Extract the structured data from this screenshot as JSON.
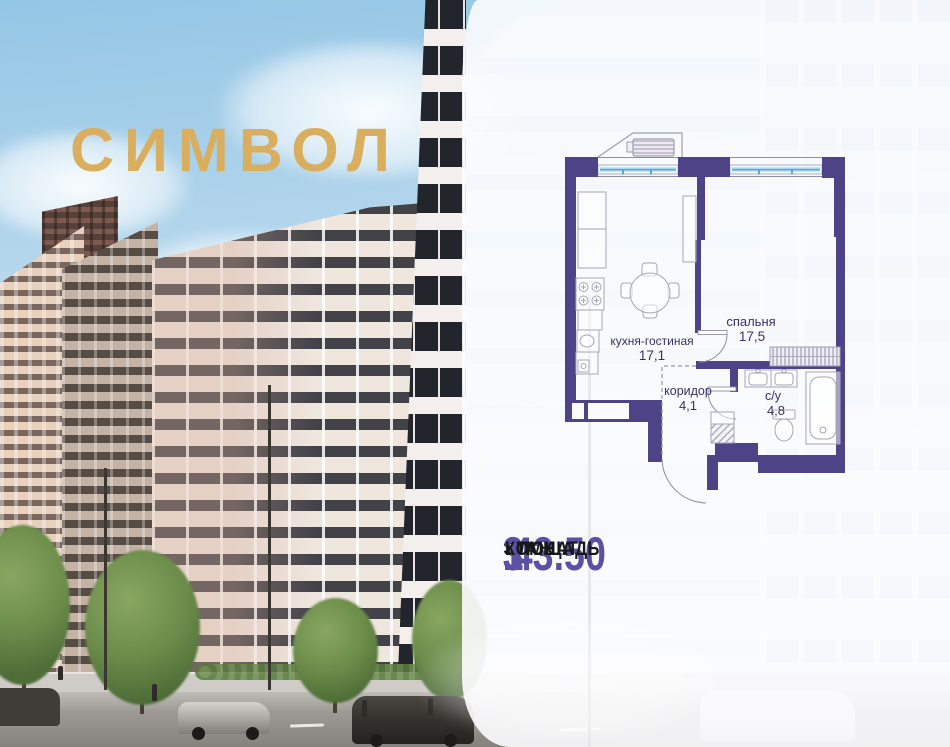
{
  "logo": {
    "text": "СИМВОЛ",
    "color": "#d9ae5f"
  },
  "floor_plan": {
    "wall_color": "#4e4386",
    "window_color": "#a9d6f0",
    "label_color": "#3a3066",
    "rooms": [
      {
        "name": "кухня-гостиная",
        "area": "17,1"
      },
      {
        "name": "спальня",
        "area": "17,5"
      },
      {
        "name": "коридор",
        "area": "4,1"
      },
      {
        "name": "с/у",
        "area": "4,8"
      }
    ]
  },
  "stats": {
    "value_color": "#5b50a5",
    "items": [
      {
        "value": "43.50",
        "label": "ПЛОЩАДЬ"
      },
      {
        "value": "3",
        "label": "ЭТАЖ"
      },
      {
        "value": "1",
        "label": "КОМНАТ"
      }
    ]
  }
}
